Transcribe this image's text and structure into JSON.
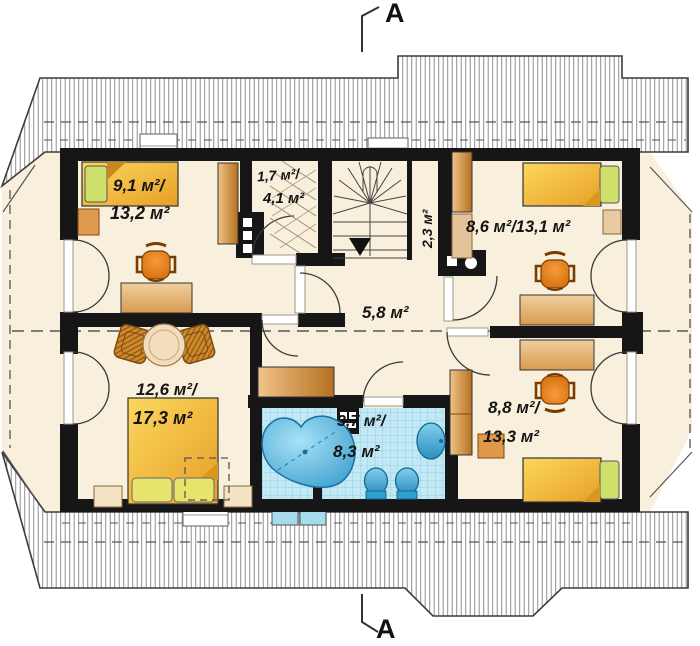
{
  "section": {
    "top_label": "A",
    "bottom_label": "A"
  },
  "rooms": {
    "bedroom_top_left": {
      "line1": "9,1 м²/",
      "line2": "13,2 м²"
    },
    "closet": {
      "line1": "1,7 м²/",
      "line2": "4,1 м²"
    },
    "stair_nook": {
      "line1": "2,3 м²"
    },
    "bedroom_top_right": {
      "line1": "8,6 м²/13,1 м²"
    },
    "hallway": {
      "line1": "5,8 м²"
    },
    "bedroom_bottom_left": {
      "line1": "12,6 м²/",
      "line2": "17,3 м²"
    },
    "bathroom": {
      "line1": "3,7 м²/",
      "line2": "8,3 м²"
    },
    "bedroom_bottom_right": {
      "line1": "8,8 м²/",
      "line2": "13,3 м²"
    }
  },
  "colors": {
    "wall": "#161616",
    "floor": "#f8f0dc",
    "bed_yellow": "#f2b935",
    "pillow_green": "#cfe06a",
    "wood_furniture": "#d0853c",
    "chair_orange": "#e8821e",
    "bath_tile": "#c2e8f4",
    "bath_fixture": "#38acdf",
    "roof_hatch": "#8f8f8f"
  }
}
